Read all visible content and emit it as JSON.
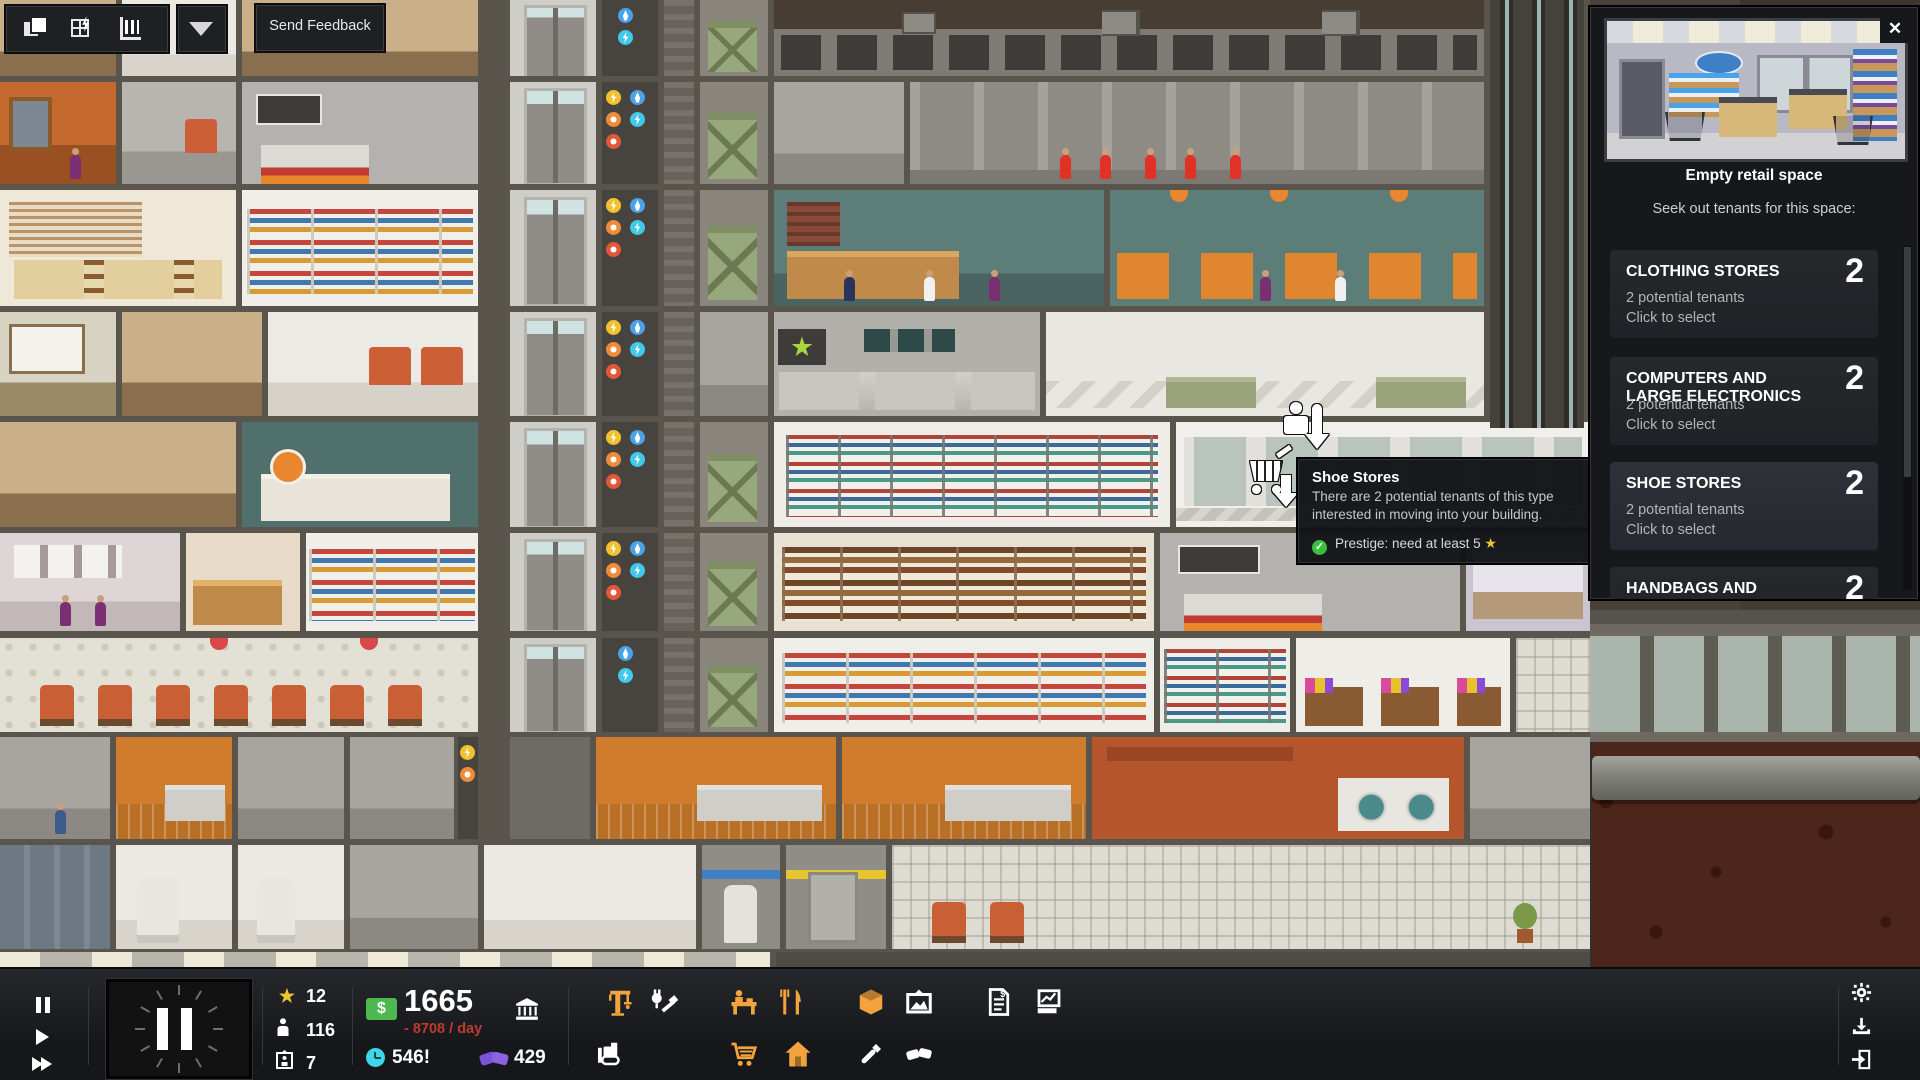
{
  "app": "Project Highrise building view",
  "feedback_toolbar": {
    "send_feedback_label": "Send Feedback",
    "icons": [
      "layers-icon",
      "blueprint-grid-icon",
      "building-stats-icon",
      "dropdown-arrow-icon"
    ]
  },
  "tenant_panel": {
    "title": "Empty retail space",
    "subtitle": "Seek out tenants for this space:",
    "close_label": "✕",
    "categories": [
      {
        "name": "CLOTHING STORES",
        "count": "2",
        "line1": "2 potential tenants",
        "line2": "Click to select",
        "highlighted": false
      },
      {
        "name": "COMPUTERS AND LARGE ELECTRONICS",
        "count": "2",
        "line1": "2 potential tenants",
        "line2": "Click to select",
        "highlighted": false
      },
      {
        "name": "SHOE STORES",
        "count": "2",
        "line1": "2 potential tenants",
        "line2": "Click to select",
        "highlighted": true
      },
      {
        "name": "HANDBAGS AND BRIEFCASES",
        "count": "2",
        "line1": "",
        "line2": "",
        "highlighted": false
      }
    ]
  },
  "tooltip": {
    "title": "Shoe Stores",
    "body": "There are 2 potential tenants of this type interested in moving into your building.",
    "requirement": "Prestige: need at least 5",
    "check": "✓",
    "star": "★"
  },
  "status_bar": {
    "playback_icons": [
      "pause-icon",
      "play-icon",
      "fast-forward-icon"
    ],
    "clock_state": "paused",
    "stats": {
      "prestige_star": "★",
      "prestige": "12",
      "population": "116",
      "floors": "7"
    },
    "money": {
      "currency": "$",
      "balance": "1665",
      "per_day": "- 8708 / day"
    },
    "buzz": "546!",
    "favors": "429",
    "tool_icons_row1": [
      "crane-icon",
      "utilities-icon",
      "office-desk-icon",
      "restaurant-icon",
      "goods-icon",
      "art-frame-icon",
      "finances-icon",
      "reports-icon"
    ],
    "tool_icons_row2": [
      "bulldozer-icon",
      "retail-cart-icon",
      "apartment-icon",
      "paint-icon",
      "deals-icon"
    ],
    "system_icons": [
      "settings-gear-icon",
      "save-icon",
      "exit-icon"
    ]
  },
  "scene_icons": [
    "shopping-cart-marker-icon",
    "move-out-marker-icon",
    "green-star-sign",
    "utility-bolt-icon",
    "utility-phone-icon",
    "utility-tv-icon",
    "utility-water-icon",
    "utility-gas-icon"
  ],
  "colors": {
    "accent_orange": "#F2A33C",
    "money_green": "#4DB84D",
    "negative_red": "#C03A30",
    "buzz_cyan": "#3FD6E8",
    "favors_purple": "#7B52D8",
    "prestige_gold": "#F0C330",
    "check_green": "#3DBF3D",
    "panel_bg": "#17181B",
    "card_bg": "#26282C"
  }
}
